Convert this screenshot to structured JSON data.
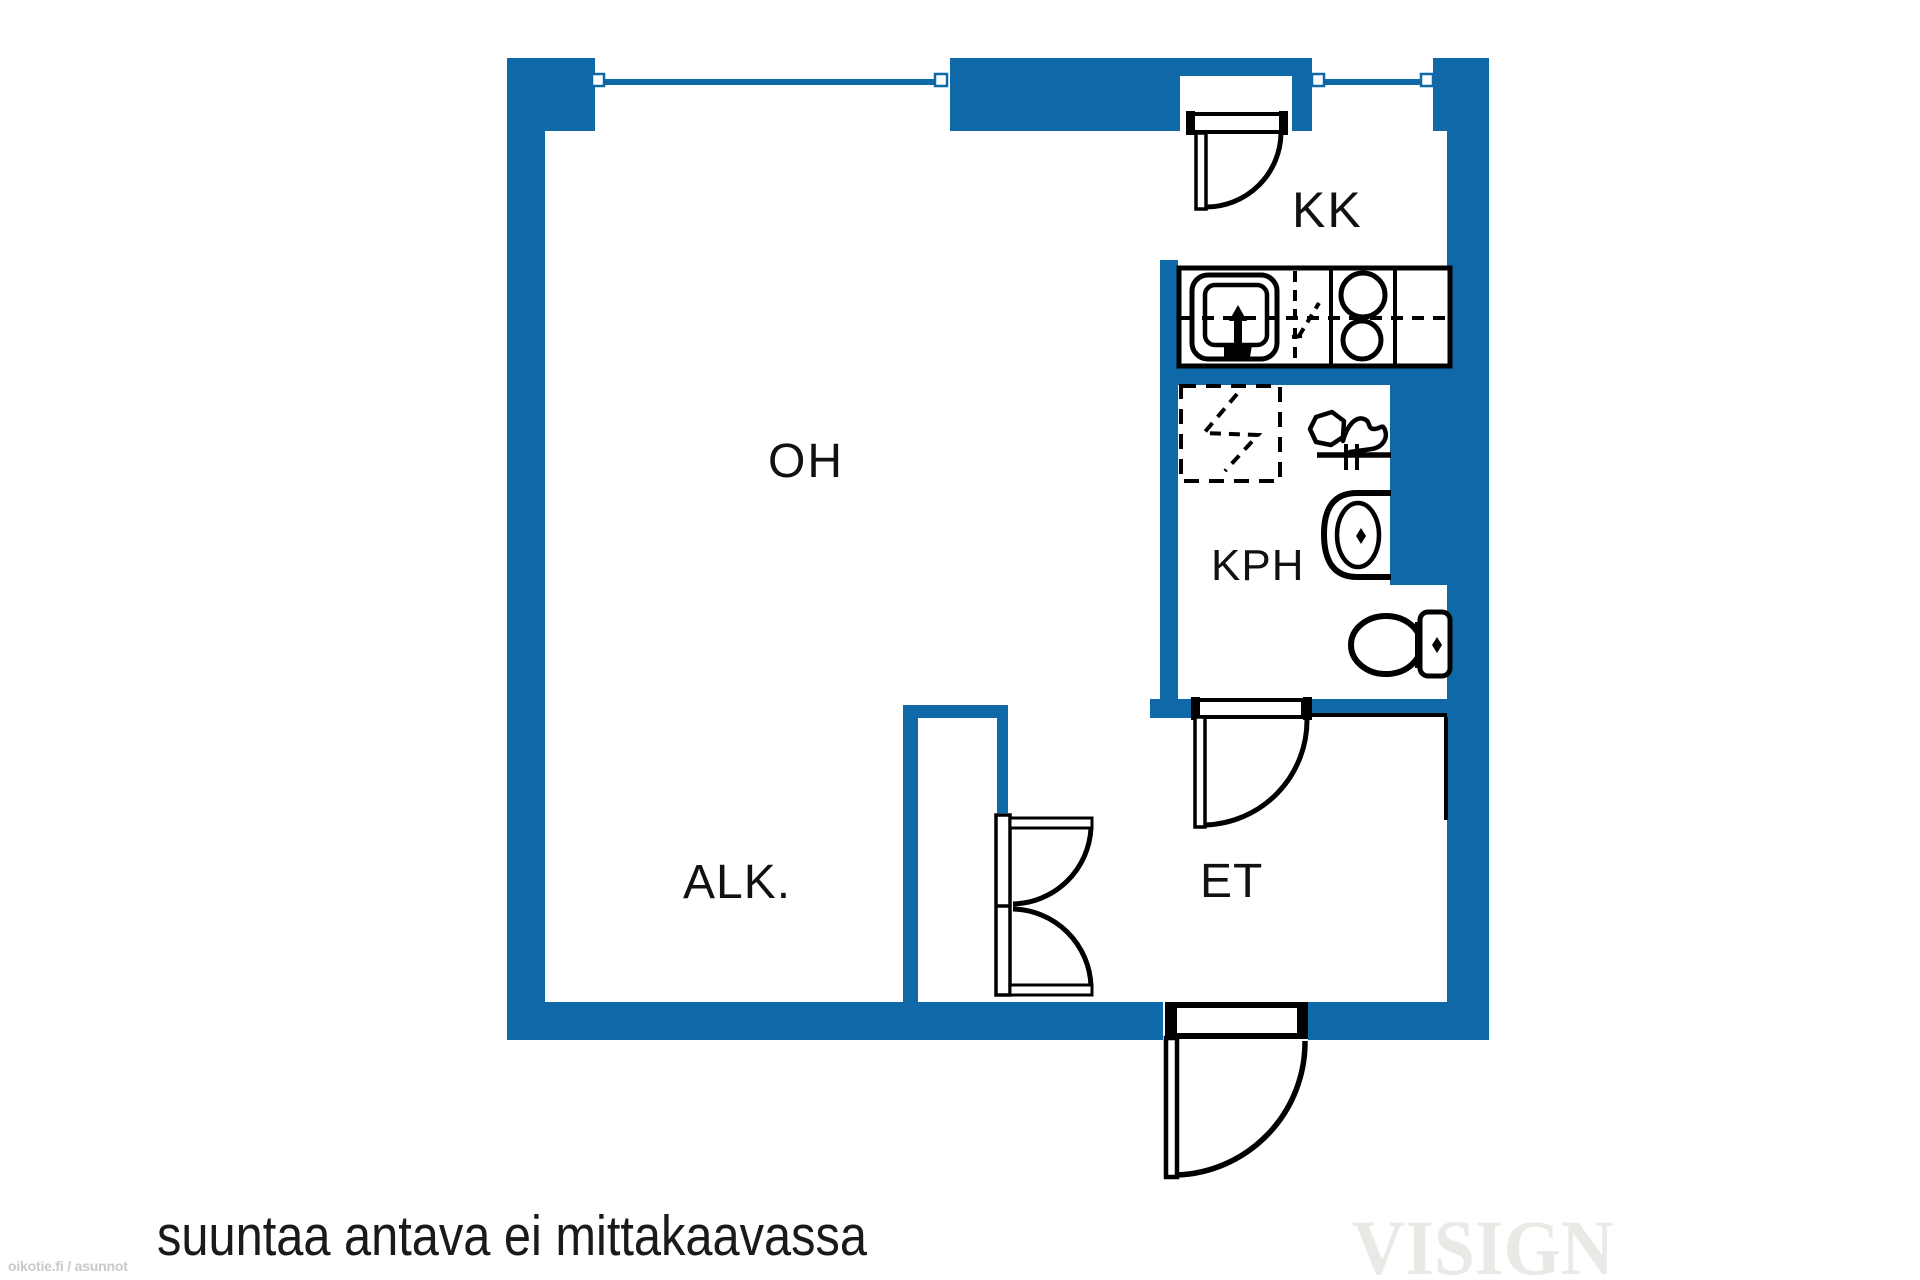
{
  "colors": {
    "background": "#ffffff",
    "wall": "#0f68a7",
    "line": "#000000",
    "label": "#111111",
    "caption": "#1a1a1a",
    "watermark_visign": "#ebe9e6",
    "watermark_oikotie": "#c9c9c9"
  },
  "rooms": {
    "oh": {
      "label": "OH"
    },
    "kk": {
      "label": "KK"
    },
    "kph": {
      "label": "KPH"
    },
    "alk": {
      "label": "ALK."
    },
    "et": {
      "label": "ET"
    }
  },
  "caption": "suuntaa antava ei mittakaavassa",
  "watermarks": {
    "brand": "VISIGN",
    "source": "oikotie.fi / asunnot"
  },
  "plan_elements": {
    "windows": 2,
    "swing_doors": [
      "kk-exterior-door",
      "kph-door",
      "front-door"
    ],
    "double_doors": [
      "closet-double-door"
    ],
    "kitchen_fixtures": [
      "sink",
      "dishwasher-space",
      "stove-two-burners",
      "counter"
    ],
    "bathroom_fixtures": [
      "shower",
      "washing-connection",
      "washbasin",
      "toilet"
    ]
  }
}
